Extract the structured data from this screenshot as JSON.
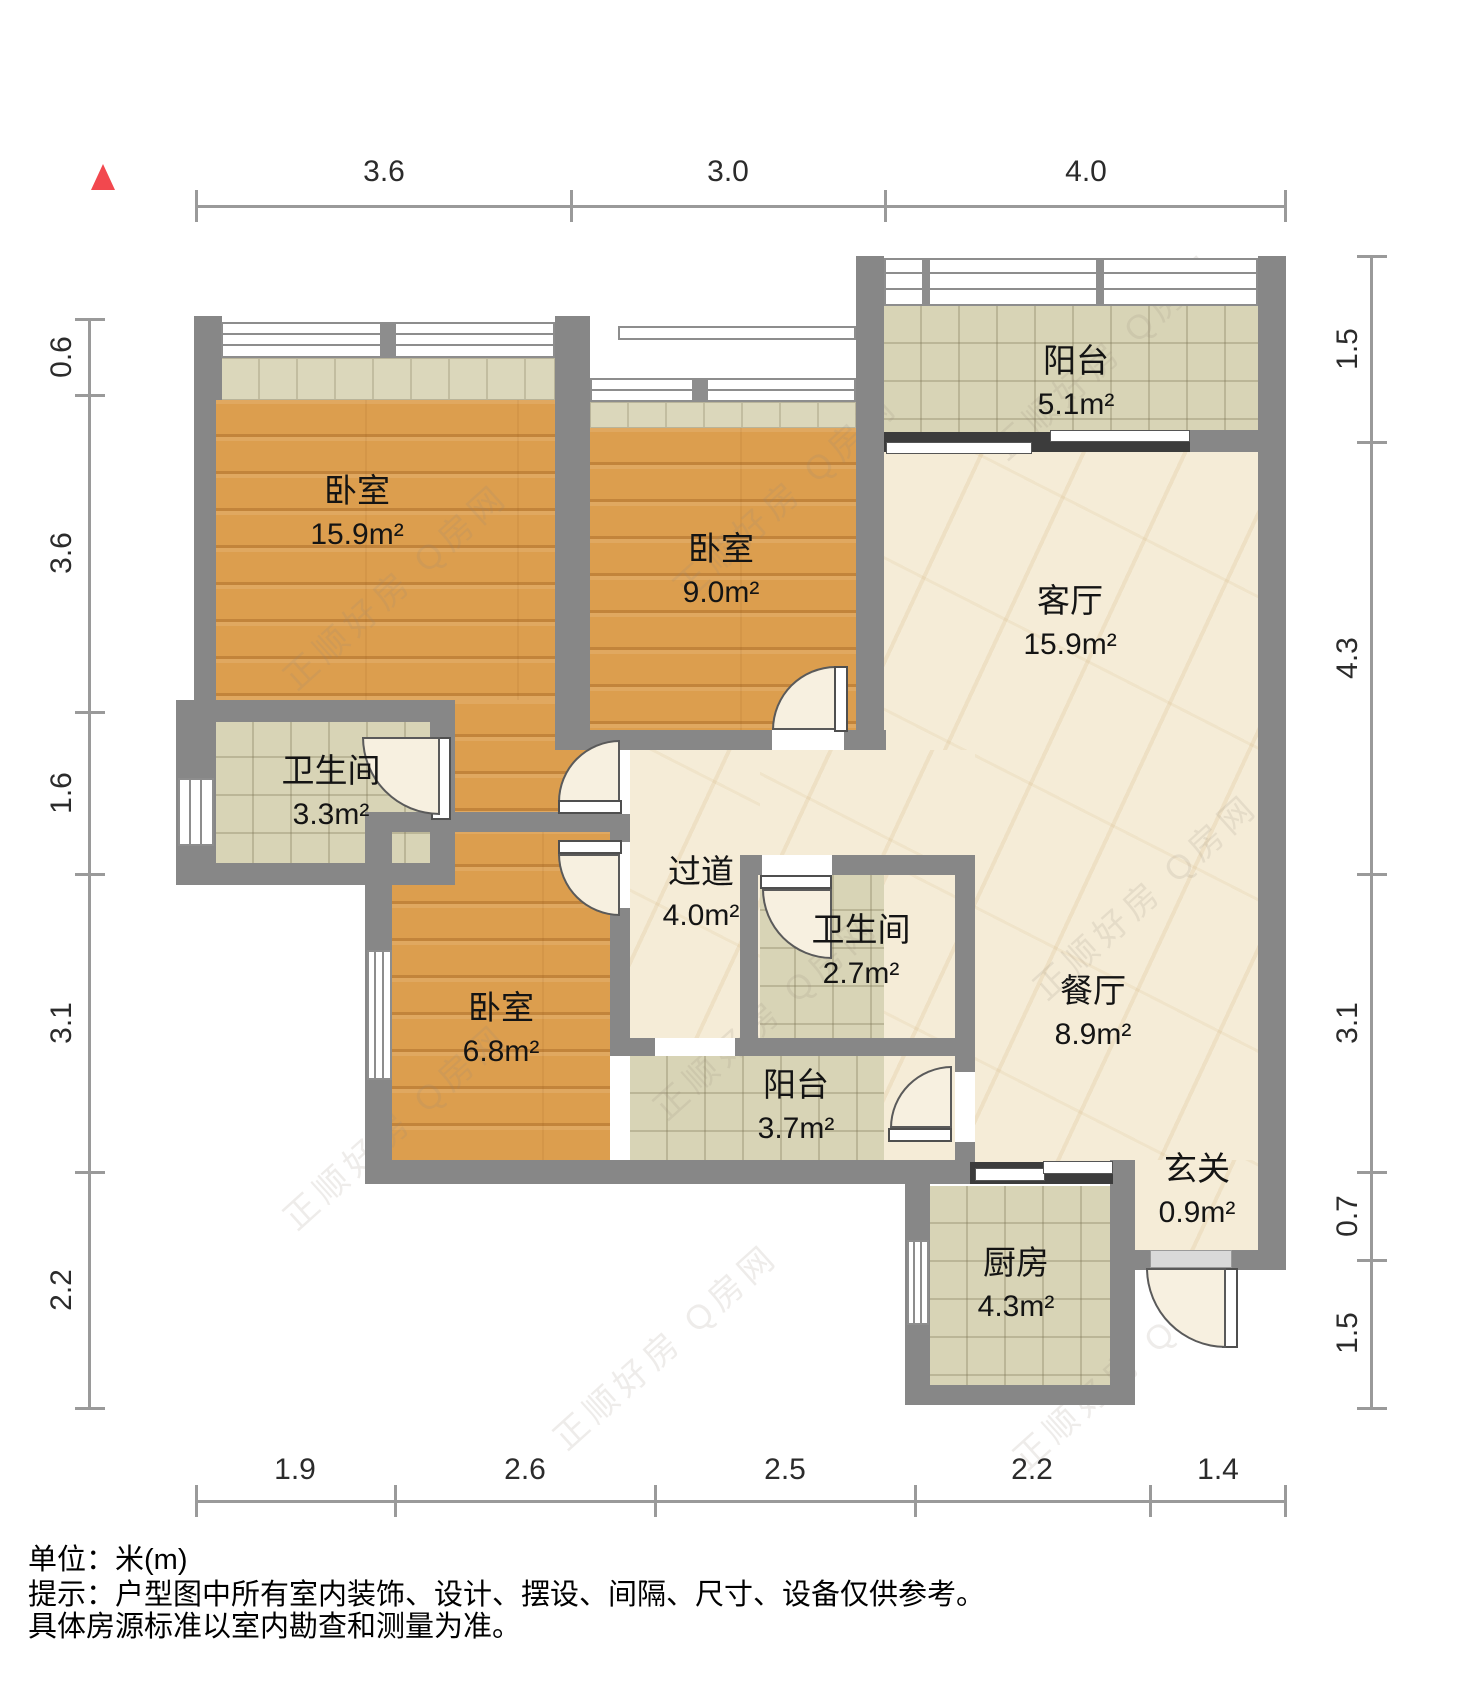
{
  "dims": {
    "top": [
      "3.6",
      "3.0",
      "4.0"
    ],
    "bottom": [
      "1.9",
      "2.6",
      "2.5",
      "2.2",
      "1.4"
    ],
    "left": [
      "0.6",
      "3.6",
      "1.6",
      "3.1",
      "2.2"
    ],
    "right": [
      "1.5",
      "4.3",
      "3.1",
      "0.7",
      "1.5"
    ]
  },
  "rooms": [
    {
      "id": "bedroom-master",
      "name": "卧室",
      "area": "15.9m²"
    },
    {
      "id": "bedroom-middle",
      "name": "卧室",
      "area": "9.0m²"
    },
    {
      "id": "balcony-north",
      "name": "阳台",
      "area": "5.1m²"
    },
    {
      "id": "living-room",
      "name": "客厅",
      "area": "15.9m²"
    },
    {
      "id": "bathroom-master",
      "name": "卫生间",
      "area": "3.3m²"
    },
    {
      "id": "hallway",
      "name": "过道",
      "area": "4.0m²"
    },
    {
      "id": "bathroom-second",
      "name": "卫生间",
      "area": "2.7m²"
    },
    {
      "id": "bedroom-small",
      "name": "卧室",
      "area": "6.8m²"
    },
    {
      "id": "balcony-south",
      "name": "阳台",
      "area": "3.7m²"
    },
    {
      "id": "dining-room",
      "name": "餐厅",
      "area": "8.9m²"
    },
    {
      "id": "entry",
      "name": "玄关",
      "area": "0.9m²"
    },
    {
      "id": "kitchen",
      "name": "厨房",
      "area": "4.3m²"
    }
  ],
  "notes": {
    "unit": "单位：米(m)",
    "tip_line1": "提示：户型图中所有室内装饰、设计、摆设、间隔、尺寸、设备仅供参考。",
    "tip_line2": "具体房源标准以室内勘查和测量为准。"
  },
  "watermark": "正顺好房 Q房网",
  "colors": {
    "wall": "#878787",
    "wood": "#dc9e4e",
    "tile": "#d8d4b6",
    "marble": "#f5ecd7",
    "north_arrow": "#f2484e"
  }
}
